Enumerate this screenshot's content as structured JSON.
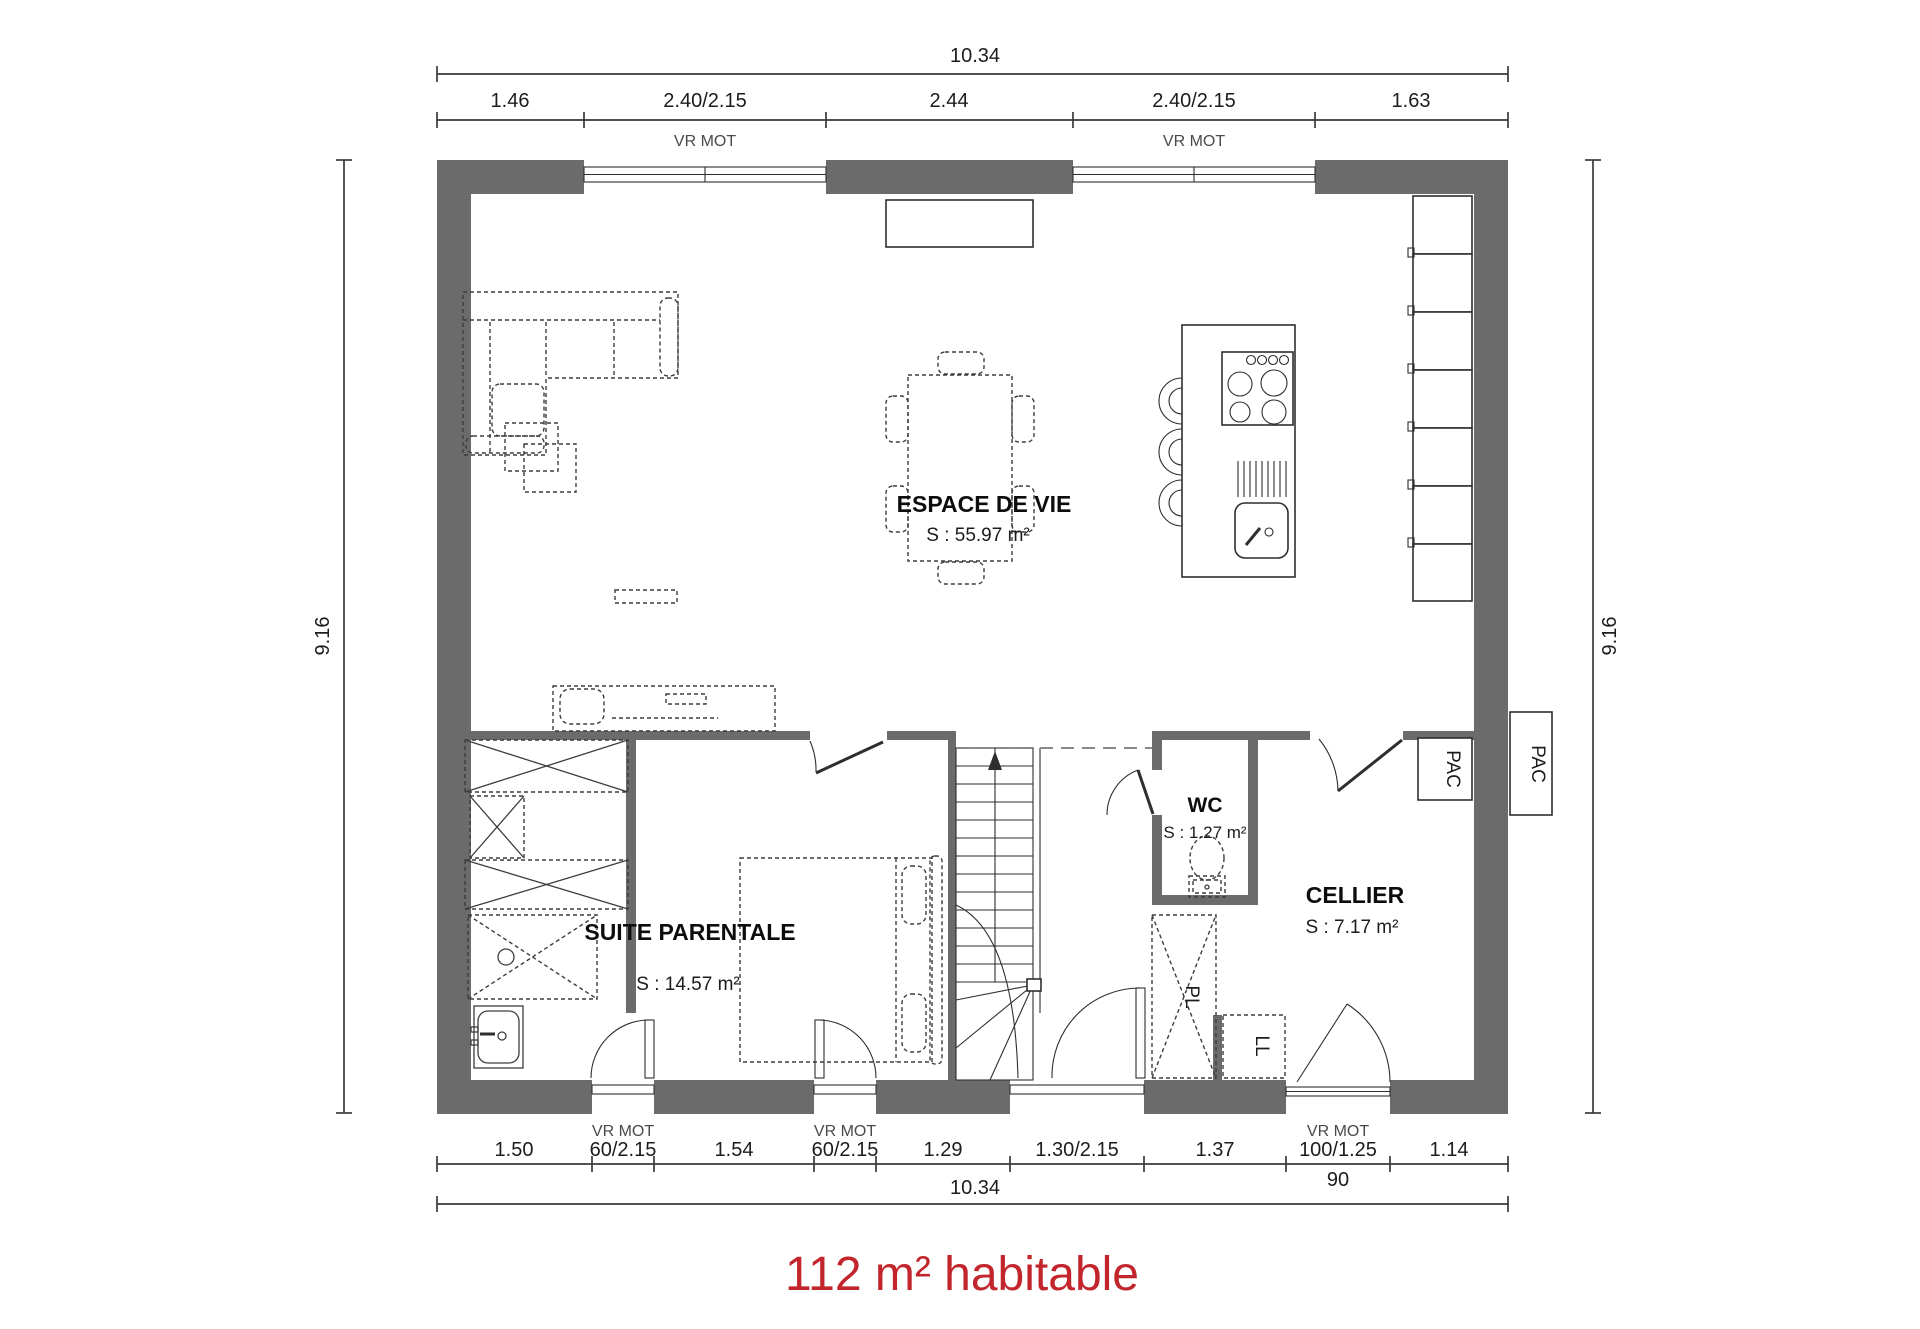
{
  "page": {
    "footer_label": "112 m² habitable",
    "footer_color": "#c2252c"
  },
  "dimensions": {
    "top": {
      "total": "10.34",
      "segments": [
        "1.46",
        "2.40/2.15",
        "2.44",
        "2.40/2.15",
        "1.63"
      ],
      "shutters": [
        "VR MOT",
        "VR MOT"
      ]
    },
    "bottom": {
      "total": "10.34",
      "segments": [
        "1.50",
        "60/2.15",
        "1.54",
        "60/2.15",
        "1.29",
        "1.30/2.15",
        "1.37",
        "100/1.25",
        "1.14"
      ],
      "shutters": [
        "VR MOT",
        "VR MOT",
        "VR MOT"
      ],
      "sub_note": "90"
    },
    "left": "9.16",
    "right": "9.16"
  },
  "rooms": {
    "living": {
      "name": "ESPACE DE VIE",
      "area": "S : 55.97 m²"
    },
    "master": {
      "name": "SUITE PARENTALE",
      "area": "S : 14.57 m²"
    },
    "wc": {
      "name": "WC",
      "area": "S : 1.27 m²"
    },
    "cellar": {
      "name": "CELLIER",
      "area": "S : 7.17 m²"
    }
  },
  "equipment": {
    "heat_pump_inner": "PAC",
    "heat_pump_outer": "PAC",
    "closet": "PL",
    "washing_machine": "LL"
  }
}
